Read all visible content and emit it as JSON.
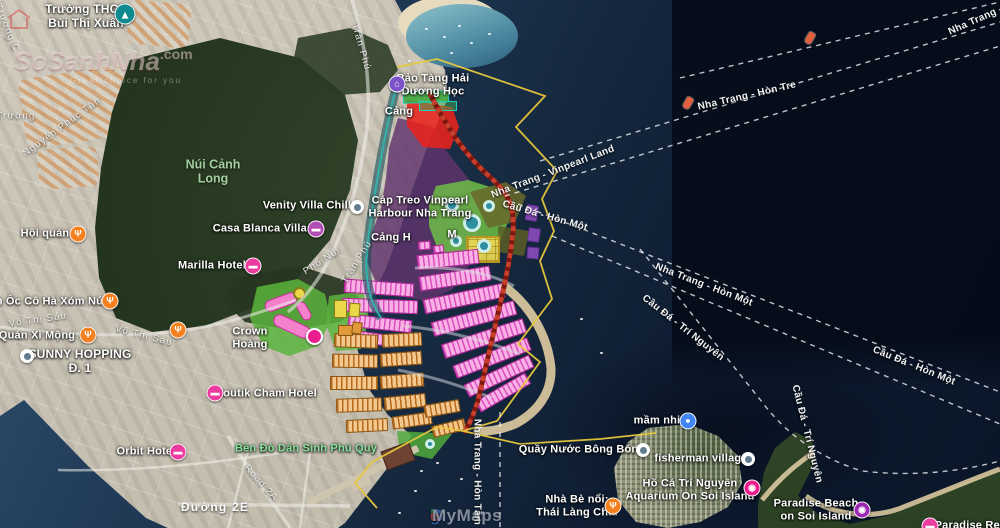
{
  "watermark": {
    "brand": "SoSanhNha",
    "suffix": ".com",
    "tagline": "Great choice for you"
  },
  "attribution": {
    "letters": [
      [
        "G",
        "#4285F4"
      ],
      [
        "o",
        "#EA4335"
      ],
      [
        "o",
        "#FBBC05"
      ],
      [
        "g",
        "#4285F4"
      ],
      [
        "l",
        "#34A853"
      ],
      [
        "e",
        "#EA4335"
      ]
    ],
    "product": "MyMaps"
  },
  "colors": {
    "plan_boundary": "#E6C73C",
    "plan_road": "#C8402C",
    "residential_pink": "#F9B0E4",
    "residential_orange": "#F2C88E",
    "mixed_use_purple": "#60346E",
    "port_red": "#E8231E",
    "park_green": "#6EBE46",
    "commercial_yellow": "#ECD854",
    "canal_teal": "#2FB8B0",
    "restaurant_icon": "#F4801F",
    "hotel_icon": "#EC3C9F",
    "museum_icon": "#7B52C7",
    "school_icon": "#0F8A8F",
    "kindergarten_icon": "#4285F4",
    "camera_pink": "#E91E8C",
    "camera_purple": "#9C27B0",
    "lodging_purple": "#B14DB3",
    "green_poi_text": "#86E29B"
  },
  "pois": [
    {
      "name": "truong-thcs-bui-thi-xuan",
      "icon": {
        "type": "school",
        "color": "#0F8A8F",
        "x": 125,
        "y": 14,
        "s": 21
      },
      "label": {
        "lines": [
          "Trường THCS",
          "Bùi Thị Xuân"
        ],
        "x": 86,
        "y": 17,
        "size": 12
      }
    },
    {
      "name": "bao-tang-hai-duong-hoc",
      "icon": {
        "type": "museum",
        "color": "#7B52C7",
        "x": 397,
        "y": 84
      },
      "label": {
        "lines": [
          "Bảo Tàng Hải",
          "Dương Học"
        ],
        "x": 433,
        "y": 85
      }
    },
    {
      "name": "cang-cau-da",
      "label": {
        "lines": [
          "Cảng"
        ],
        "x": 399,
        "y": 112
      }
    },
    {
      "name": "cap-treo-vinpearl",
      "label": {
        "lines": [
          "Cáp Treo Vinpearl",
          "Harbour Nha Trang"
        ],
        "x": 420,
        "y": 207
      }
    },
    {
      "name": "cang-h-fragment",
      "label": {
        "lines": [
          "Cảng H"
        ],
        "x": 391,
        "y": 238
      }
    },
    {
      "name": "cang-m-fragment",
      "label": {
        "lines": [
          "M"
        ],
        "x": 452,
        "y": 235
      }
    },
    {
      "name": "venity-villa-chill",
      "icon": {
        "type": "dot",
        "x": 357,
        "y": 207,
        "s": 14
      },
      "label": {
        "lines": [
          "Venity Villa Chill"
        ],
        "x": 307,
        "y": 206
      }
    },
    {
      "name": "casa-blanca-villas",
      "icon": {
        "type": "hotel",
        "color": "#B14DB3",
        "x": 316,
        "y": 229
      },
      "label": {
        "lines": [
          "Casa Blanca Villas"
        ],
        "x": 263,
        "y": 229
      }
    },
    {
      "name": "marilla-hotel",
      "icon": {
        "type": "hotel",
        "color": "#EC3C9F",
        "x": 253,
        "y": 266
      },
      "label": {
        "lines": [
          "Marilla Hotel"
        ],
        "x": 212,
        "y": 266
      }
    },
    {
      "name": "hoi-quan",
      "icon": {
        "type": "restaurant",
        "color": "#F4801F",
        "x": 78,
        "y": 234
      },
      "label": {
        "lines": [
          "Hội quán"
        ],
        "x": 45,
        "y": 234
      }
    },
    {
      "name": "quan-oc-co-ha-xom-nui",
      "icon": {
        "type": "restaurant",
        "color": "#F4801F",
        "x": 110,
        "y": 301
      },
      "label": {
        "lines": [
          "Quán Ốc Cô Hà Xóm Núi"
        ],
        "x": 40,
        "y": 302
      }
    },
    {
      "name": "quan-xi-mong",
      "icon": {
        "type": "restaurant",
        "color": "#F4801F",
        "x": 88,
        "y": 335
      },
      "label": {
        "lines": [
          "Quán Xì Mộng"
        ],
        "x": 37,
        "y": 336
      }
    },
    {
      "name": "restaurant-vo-thi-sau",
      "icon": {
        "type": "restaurant",
        "color": "#F4801F",
        "x": 178,
        "y": 330
      }
    },
    {
      "name": "sunny-hopping",
      "icon": {
        "type": "dot",
        "x": 27,
        "y": 356,
        "s": 14
      },
      "label": {
        "lines": [
          "SUNNY HOPPING",
          "Đ. 1"
        ],
        "x": 80,
        "y": 362,
        "size": 12
      }
    },
    {
      "name": "crown-hoang",
      "label": {
        "lines": [
          "Crown",
          "Hoàng"
        ],
        "x": 250,
        "y": 338
      }
    },
    {
      "name": "boutik-cham-hotel",
      "icon": {
        "type": "hotel",
        "color": "#EC3C9F",
        "x": 215,
        "y": 393
      },
      "label": {
        "lines": [
          "Boutik Cham Hotel"
        ],
        "x": 266,
        "y": 394
      }
    },
    {
      "name": "orbit-hotel",
      "icon": {
        "type": "hotel",
        "color": "#EC3C9F",
        "x": 178,
        "y": 452
      },
      "label": {
        "lines": [
          "Orbit Hotel"
        ],
        "x": 146,
        "y": 452
      }
    },
    {
      "name": "ben-do-dan-sinh-phu-quy",
      "label": {
        "lines": [
          "Bến Đò Dân Sinh Phú Quý"
        ],
        "x": 306,
        "y": 449,
        "color": "#86E29B"
      }
    },
    {
      "name": "quay-nuoc-bong-bong",
      "icon": {
        "type": "dot",
        "x": 643,
        "y": 450,
        "s": 14
      },
      "label": {
        "lines": [
          "Quầy Nước Bông Bóng"
        ],
        "x": 582,
        "y": 450
      }
    },
    {
      "name": "mam-nhi",
      "icon": {
        "type": "kindergarten",
        "color": "#4285F4",
        "x": 688,
        "y": 421
      },
      "label": {
        "lines": [
          "mầm nhi"
        ],
        "x": 657,
        "y": 421
      }
    },
    {
      "name": "fisherman-village",
      "icon": {
        "type": "dot",
        "x": 748,
        "y": 459,
        "s": 14
      },
      "label": {
        "lines": [
          "fisherman village"
        ],
        "x": 701,
        "y": 459
      }
    },
    {
      "name": "ho-ca-tri-nguyen-aquarium",
      "icon": {
        "type": "camera",
        "color": "#E91E8C",
        "x": 752,
        "y": 488
      },
      "label": {
        "lines": [
          "Hồ Cá Trí Nguyên",
          "Aquarium On Soi Island"
        ],
        "x": 690,
        "y": 490
      }
    },
    {
      "name": "nha-be-noi-thai-lang-chai",
      "icon": {
        "type": "restaurant",
        "color": "#F4801F",
        "x": 613,
        "y": 506
      },
      "label": {
        "lines": [
          "Nhà Bè nổi:",
          "Thái Làng Chài"
        ],
        "x": 577,
        "y": 506
      }
    },
    {
      "name": "paradise-beach",
      "icon": {
        "type": "camera",
        "color": "#9C27B0",
        "x": 862,
        "y": 510
      },
      "label": {
        "lines": [
          "Paradise Beach",
          "on Soi Island"
        ],
        "x": 816,
        "y": 510
      }
    },
    {
      "name": "paradise-resort",
      "icon": {
        "type": "hotel",
        "color": "#EC3C9F",
        "x": 930,
        "y": 526
      },
      "label": {
        "lines": [
          "Paradise Resort"
        ],
        "x": 978,
        "y": 526
      }
    }
  ],
  "street_labels": [
    {
      "text": "Trần Phú",
      "x": 361,
      "y": 47,
      "rot": 74
    },
    {
      "text": "Trần Phú",
      "x": 357,
      "y": 262,
      "rot": -58
    },
    {
      "text": "Nguyễn Phúc Tân",
      "x": 62,
      "y": 127,
      "rot": -36
    },
    {
      "text": "Phố Núi",
      "x": 322,
      "y": 261,
      "rot": -33
    },
    {
      "text": "Võ Thị Sáu",
      "x": 38,
      "y": 320,
      "rot": -8
    },
    {
      "text": "Võ Thị Sáu",
      "x": 144,
      "y": 336,
      "rot": 14
    },
    {
      "text": "Road 2A",
      "x": 261,
      "y": 483,
      "rot": 48
    },
    {
      "text": "Đường 2E",
      "x": 215,
      "y": 507,
      "rot": 0,
      "size": 12,
      "bold": true
    },
    {
      "text": "Trường",
      "x": 16,
      "y": 116,
      "rot": 0
    },
    {
      "text": "Trường C",
      "x": 7,
      "y": 28,
      "rot": 68
    }
  ],
  "route_labels": [
    {
      "text": "Nha Trang - Hòn Tre",
      "x": 747,
      "y": 96,
      "rot": -13
    },
    {
      "text": "Nha Trang - Hòn Tre",
      "x": 995,
      "y": 12,
      "rot": -24
    },
    {
      "text": "Nha Trang - Vinpearl Land",
      "x": 553,
      "y": 172,
      "rot": -21
    },
    {
      "text": "Cầu Đá - Hòn Một",
      "x": 545,
      "y": 216,
      "rot": 16
    },
    {
      "text": "Nha Trang - Hòn Một",
      "x": 704,
      "y": 285,
      "rot": 21
    },
    {
      "text": "Cầu Đá - Trí Nguyên",
      "x": 683,
      "y": 328,
      "rot": 38
    },
    {
      "text": "Cầu Đá - Hòn Một",
      "x": 914,
      "y": 366,
      "rot": 22
    },
    {
      "text": "Cầu Đá - Trí Nguyên",
      "x": 807,
      "y": 434,
      "rot": 76
    },
    {
      "text": "Nha Trang - Hòn Tằm",
      "x": 477,
      "y": 472,
      "rot": 90
    }
  ],
  "area_labels": [
    {
      "lines": [
        "Núi Cảnh",
        "Long"
      ],
      "x": 213,
      "y": 172
    }
  ],
  "boat_markers": [
    {
      "x": 688,
      "y": 103
    },
    {
      "x": 810,
      "y": 38
    }
  ]
}
